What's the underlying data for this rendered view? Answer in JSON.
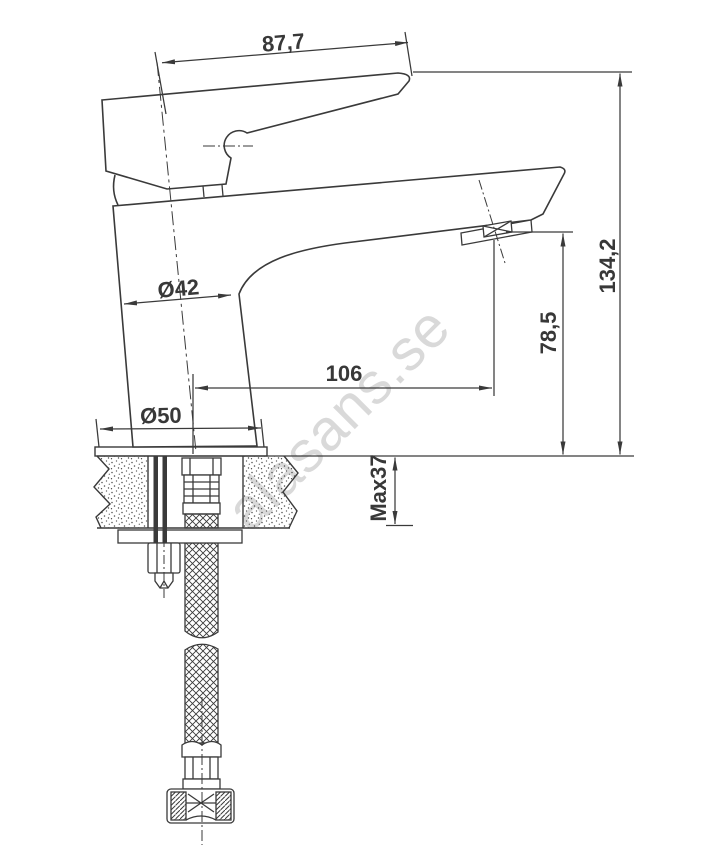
{
  "drawing": {
    "dimensions": {
      "handle_length_mm": "87,7",
      "body_diameter": "Ø42",
      "base_diameter": "Ø50",
      "spout_reach_mm": "106",
      "spout_outlet_height_mm": "78,5",
      "total_height_mm": "134,2",
      "max_mounting_thickness": "Max37"
    },
    "watermark": "alasans.se"
  }
}
